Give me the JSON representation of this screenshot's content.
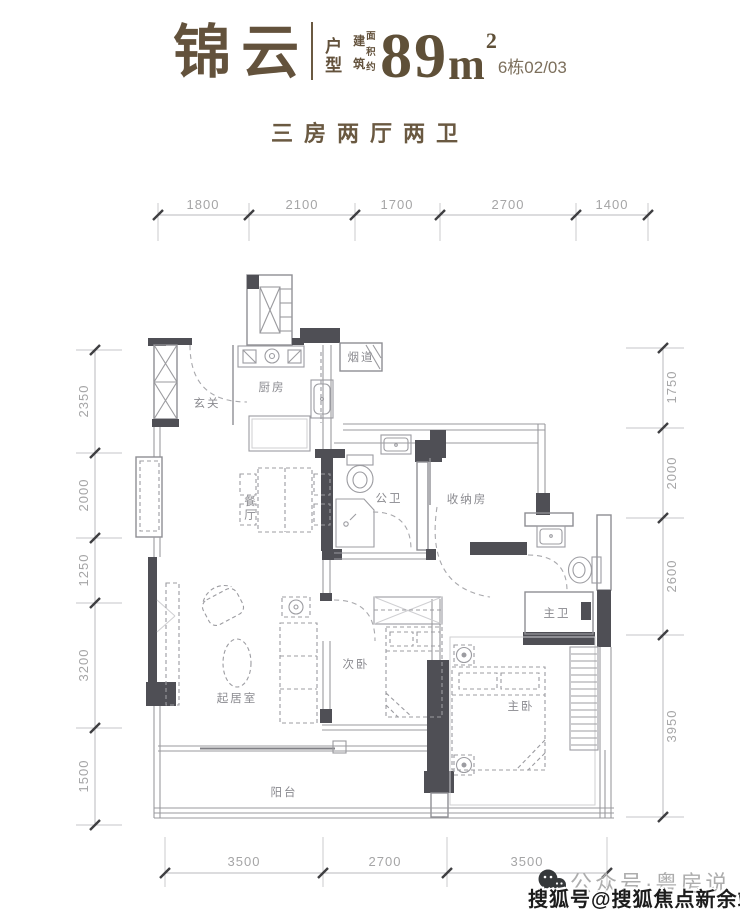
{
  "header": {
    "project_name": "锦云",
    "unit_type_label": "户型",
    "area_prefix_col1": "建筑",
    "area_prefix_col2": "面积约",
    "area_value": "89",
    "area_unit": "m",
    "area_superscript": "2",
    "building_units": "6栋02/03",
    "layout_summary": "三房两厅两卫"
  },
  "rooms": {
    "entry": "玄关",
    "kitchen": "厨房",
    "flue": "烟道",
    "dining": "餐厅",
    "guest_bath": "公卫",
    "storage": "收纳房",
    "master_bath": "主卫",
    "living": "起居室",
    "second_bedroom": "次卧",
    "master_bedroom": "主卧",
    "balcony": "阳台"
  },
  "dimensions": {
    "top": [
      "1800",
      "2100",
      "1700",
      "2700",
      "1400"
    ],
    "left": [
      "2350",
      "2000",
      "1250",
      "3200",
      "1500"
    ],
    "right": [
      "1750",
      "2000",
      "2600",
      "3950"
    ],
    "bottom": [
      "3500",
      "2700",
      "3500"
    ]
  },
  "watermarks": {
    "wechat_account": "公众号·粤房说",
    "sohu_account": "搜狐号@搜狐焦点新余站"
  },
  "colors": {
    "title_brown": "#6a5941",
    "wall_dark": "#4f4f55",
    "dim_text": "#a5a5a6",
    "watermark_gray": "#adadad",
    "watermark_dark": "#1c1c1c"
  }
}
